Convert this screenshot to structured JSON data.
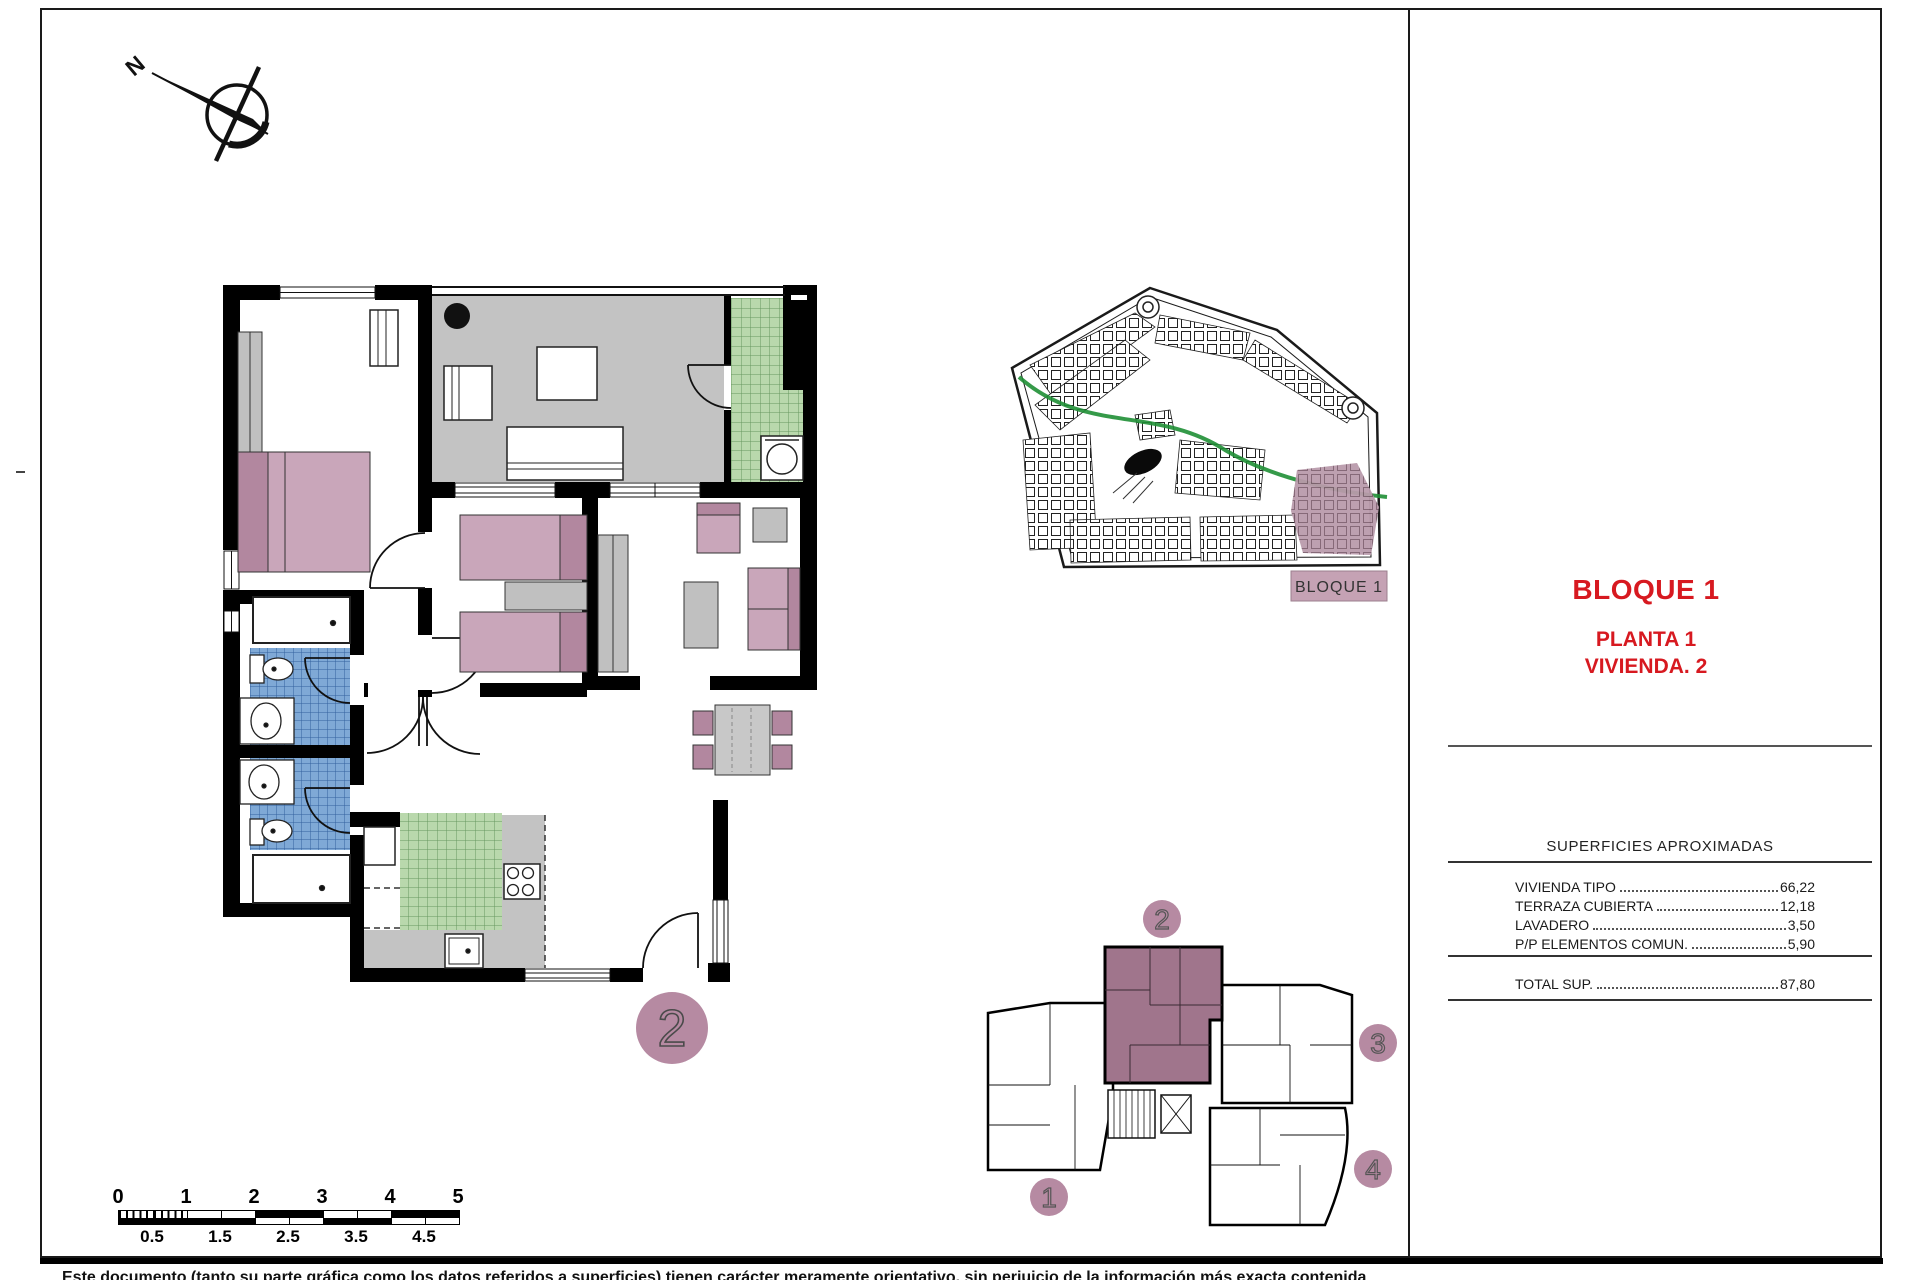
{
  "sheet": {
    "compass_north_label": "N",
    "disclaimer": "Este documento (tanto su parte gráfica como los datos referidos a superficies) tienen carácter meramente orientativo, sin perjuicio de la información más exacta contenida"
  },
  "title_block": {
    "block_title": "BLOQUE 1",
    "floor_label": "PLANTA 1",
    "unit_label": "VIVIENDA. 2"
  },
  "surfaces_table": {
    "heading": "SUPERFICIES APROXIMADAS",
    "rows": [
      {
        "label": "VIVIENDA TIPO",
        "value": "66,22"
      },
      {
        "label": "TERRAZA CUBIERTA",
        "value": "12,18"
      },
      {
        "label": "LAVADERO",
        "value": "3,50"
      },
      {
        "label": "P/P ELEMENTOS COMUN.",
        "value": "5,90"
      }
    ],
    "total": {
      "label": "TOTAL SUP.",
      "value": "87,80"
    }
  },
  "site_plan": {
    "highlight_label": "BLOQUE 1"
  },
  "key_plan": {
    "units": [
      "1",
      "2",
      "3",
      "4"
    ],
    "highlighted_unit": "2"
  },
  "floor_plan": {
    "unit_number": "2"
  },
  "scale_bar": {
    "major": [
      "0",
      "1",
      "2",
      "3",
      "4",
      "5"
    ],
    "minor": [
      "0.5",
      "1.5",
      "2.5",
      "3.5",
      "4.5"
    ]
  },
  "colors": {
    "accent_red": "#d71920",
    "mauve": "#b68aa2",
    "mauve_dark": "#a0758c",
    "mauve_light": "#c5a2b4",
    "pink": "#c9a6ba",
    "pink_dark": "#b2879f",
    "terrace_gray": "#c3c3c3",
    "tile_green": "#b9d8ac",
    "tile_blue": "#7fa9d6"
  }
}
